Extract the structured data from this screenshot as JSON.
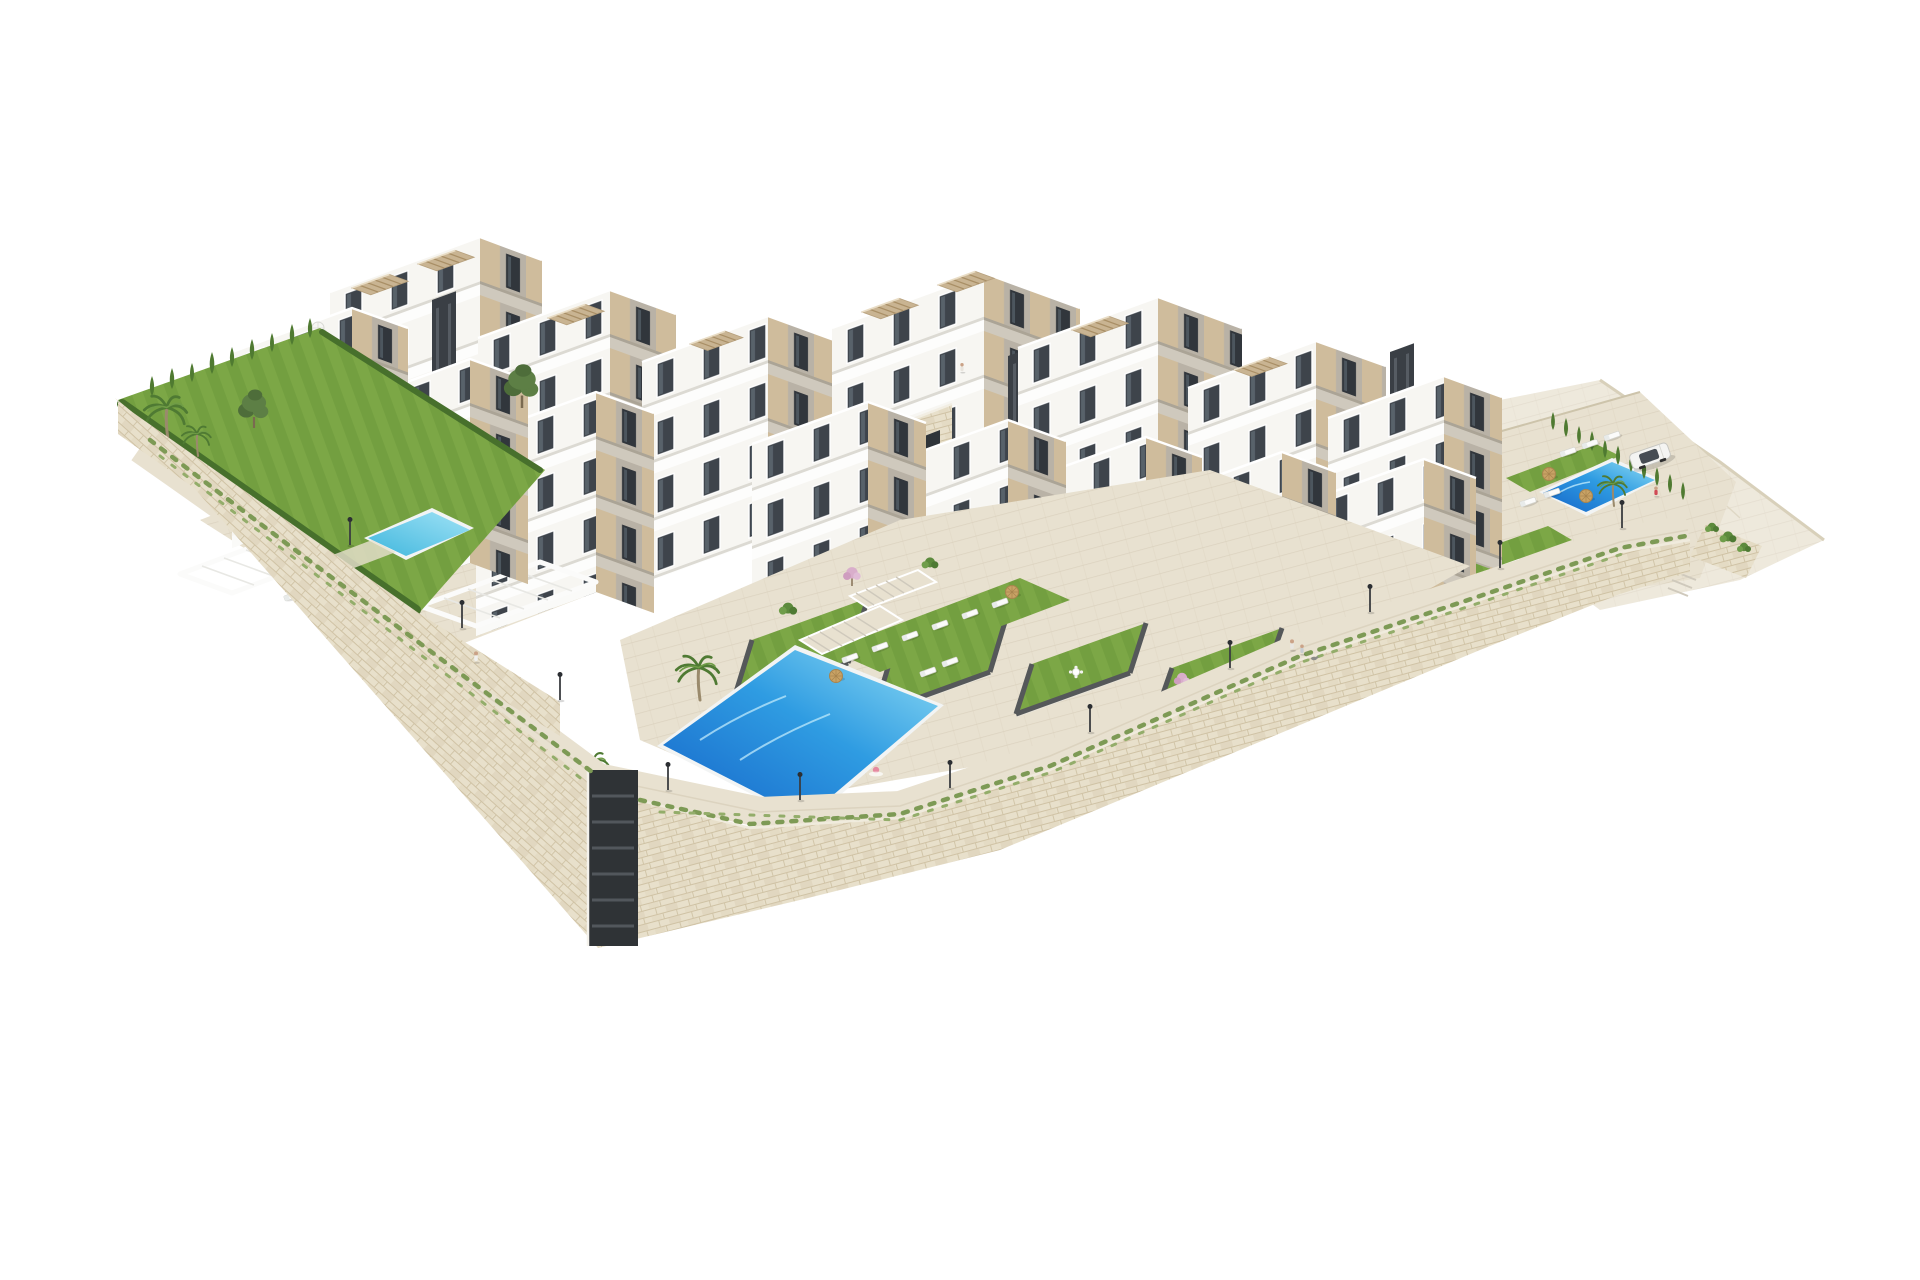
{
  "scene": {
    "type": "3d-architectural-render",
    "subject": "aerial rendering of a white hillside apartment complex on stone retaining walls with pools and gardens, isolated on a white background",
    "background": "#ffffff",
    "palette": {
      "white": "#ffffff",
      "bldg-lit": "#f7f6f2",
      "bldg-bright": "#fcfcfa",
      "bldg-shade": "#b9b2a6",
      "accent-tan": "#cfbc9c",
      "glass": "#3e444b",
      "core-dark": "#3a3f45",
      "roof": "#efede6",
      "stone": "#e8e0cb",
      "stone-dark": "#d5c9ad",
      "stone-line": "#cfc2a4",
      "pave": "#e8e1d0",
      "pave-line": "#d8cfba",
      "slope": "#ece5d3",
      "slope-edge": "#d8d0ba",
      "lawn": "#7ca746",
      "lawn-dark": "#69953a",
      "hedge": "#47702c",
      "cypress": "#4f7a31",
      "palm-green": "#4f7a33",
      "pool-deep": "#1565c9",
      "pool-mid": "#2f9ce2",
      "pool-light": "#8fdcf4",
      "pool-small": "#41b7dd",
      "parasol-straw": "#c8a265",
      "pergola": "#c9b492"
    },
    "inventory": {
      "apartment-buildings": 15,
      "swimming-pools": 3,
      "rooftop-pergolas": 8,
      "communal-pool-loungers": 6,
      "right-pool-loungers": 5,
      "left-garden-loungers": 3,
      "garden-loungers": 4,
      "palm-trees": 5,
      "pine-trees": 2,
      "cypress-trees": 20,
      "lampposts": 11,
      "people": 7,
      "dogs": 2,
      "cars": 1
    }
  }
}
